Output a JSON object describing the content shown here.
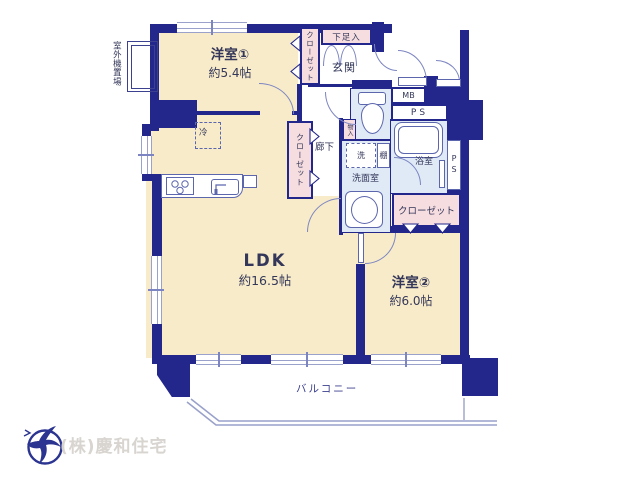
{
  "plan": {
    "rooms": {
      "western1": {
        "name": "洋室①",
        "size": "約5.4帖"
      },
      "ldk": {
        "name": "LDK",
        "size": "約16.5帖"
      },
      "western2": {
        "name": "洋室②",
        "size": "約6.0帖"
      },
      "entrance": "玄関",
      "hallway": "廊下",
      "washroom": "洗面室",
      "bathroom": "浴室",
      "balcony": "バルコニー"
    },
    "storage": {
      "closet_western1": "クローゼット",
      "closet_hallway": "クローゼット",
      "closet_western2": "クローゼット",
      "shoe_cabinet": "下足入",
      "small_storage": "物入",
      "shelf": "棚"
    },
    "labels": {
      "refrigerator": "冷",
      "laundry": "洗",
      "meter_box": "MB",
      "pipe_space_top": "PS",
      "pipe_space_side": "PS",
      "outdoor_unit": "室外機置場"
    },
    "colors": {
      "wall": "#23268a",
      "floor_cream": "#f8ebc9",
      "wet_blue": "#dfeaf6",
      "storage_pink": "#f6dde0",
      "fixture_line": "#5c66ad"
    }
  },
  "footer": {
    "company": "(株)慶和住宅"
  }
}
